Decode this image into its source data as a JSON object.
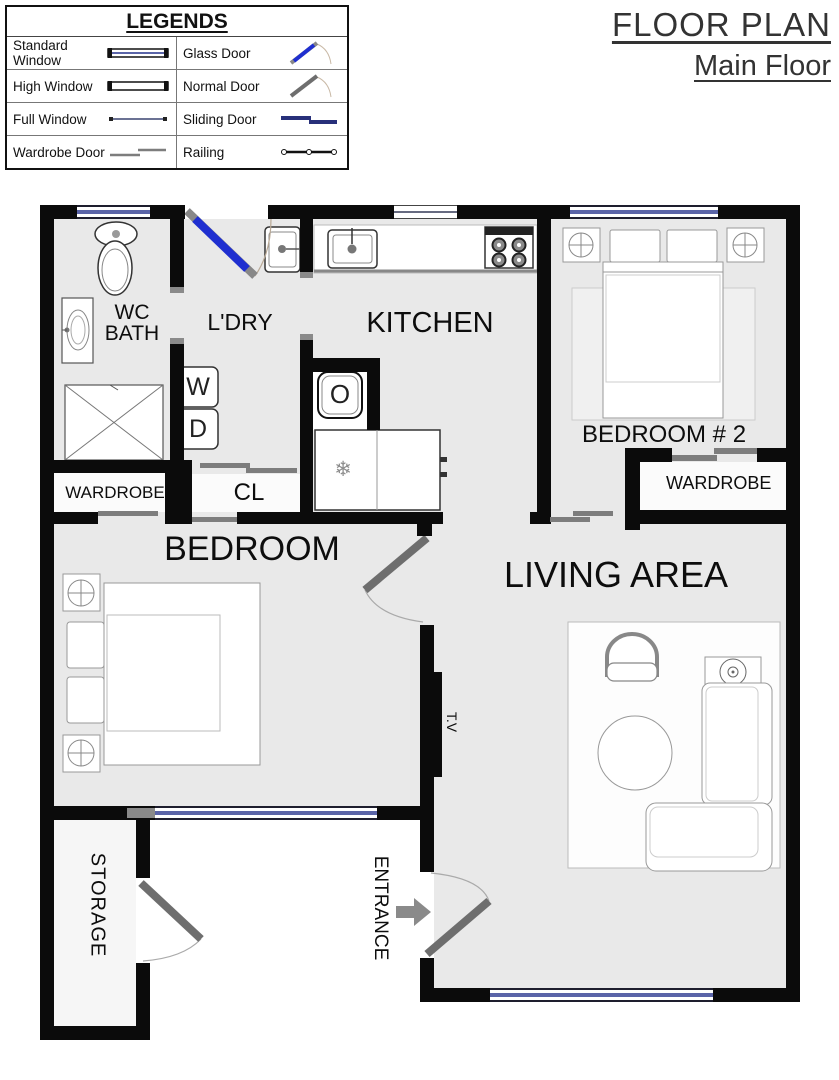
{
  "title": {
    "line1": "FLOOR PLAN",
    "line2": "Main Floor"
  },
  "legend": {
    "title": "LEGENDS",
    "items": [
      {
        "label": "Standard Window",
        "symbol": "standard-window"
      },
      {
        "label": "Glass Door",
        "symbol": "glass-door"
      },
      {
        "label": "High Window",
        "symbol": "high-window"
      },
      {
        "label": "Normal Door",
        "symbol": "normal-door"
      },
      {
        "label": "Full Window",
        "symbol": "full-window"
      },
      {
        "label": "Sliding Door",
        "symbol": "sliding-door"
      },
      {
        "label": "Wardrobe Door",
        "symbol": "wardrobe-door"
      },
      {
        "label": "Railing",
        "symbol": "railing"
      }
    ]
  },
  "rooms": {
    "wc_bath_line1": "WC",
    "wc_bath_line2": "BATH",
    "laundry": "L'DRY",
    "kitchen": "KITCHEN",
    "bedroom2": "BEDROOM # 2",
    "wardrobe_bedroom2": "WARDROBE",
    "wardrobe_main": "WARDROBE",
    "closet": "CL",
    "bedroom": "BEDROOM",
    "living": "LIVING AREA",
    "storage": "STORAGE",
    "entrance": "ENTRANCE",
    "tv": "T.V"
  },
  "appliances": {
    "washer": "W",
    "dryer": "D",
    "oven": "O",
    "freezer_icon": "❄"
  },
  "colors": {
    "wall": "#0b0b0b",
    "floor": "#e9e9e9",
    "window_blue": "#5a64a8",
    "glass_door_blue": "#1f2fd0",
    "door_gray": "#6e6e6e"
  }
}
